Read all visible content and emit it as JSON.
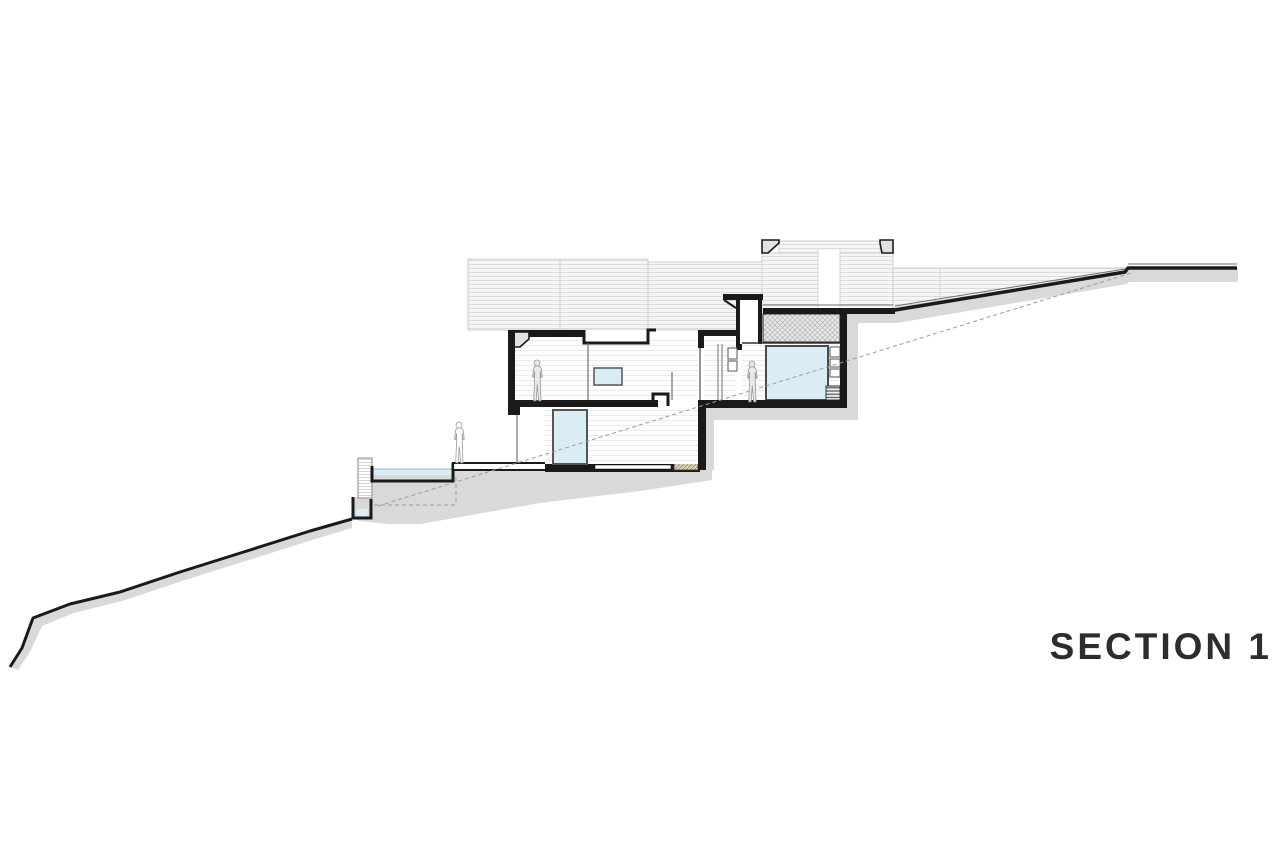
{
  "title": {
    "label": "SECTION 1"
  },
  "colors": {
    "line": "#1a1a1a",
    "earth": "#d9d9d9",
    "water": "#daedf4",
    "panel_bg": "#f5f5f5",
    "panel_line": "#dcdcdc",
    "room_line": "#ebebeb",
    "hatch_bg": "#e9e9e9",
    "hatch_line": "#b5b5b5",
    "gravel_bg": "#d6cfb6",
    "gravel_line": "#9a916f",
    "cap_fill": "#e2e2e2",
    "figure_fill": "#e9e9e9",
    "figure_stroke": "#9a9a9a",
    "dashed": "#9b9b9b",
    "title": "#2d2d2d"
  }
}
